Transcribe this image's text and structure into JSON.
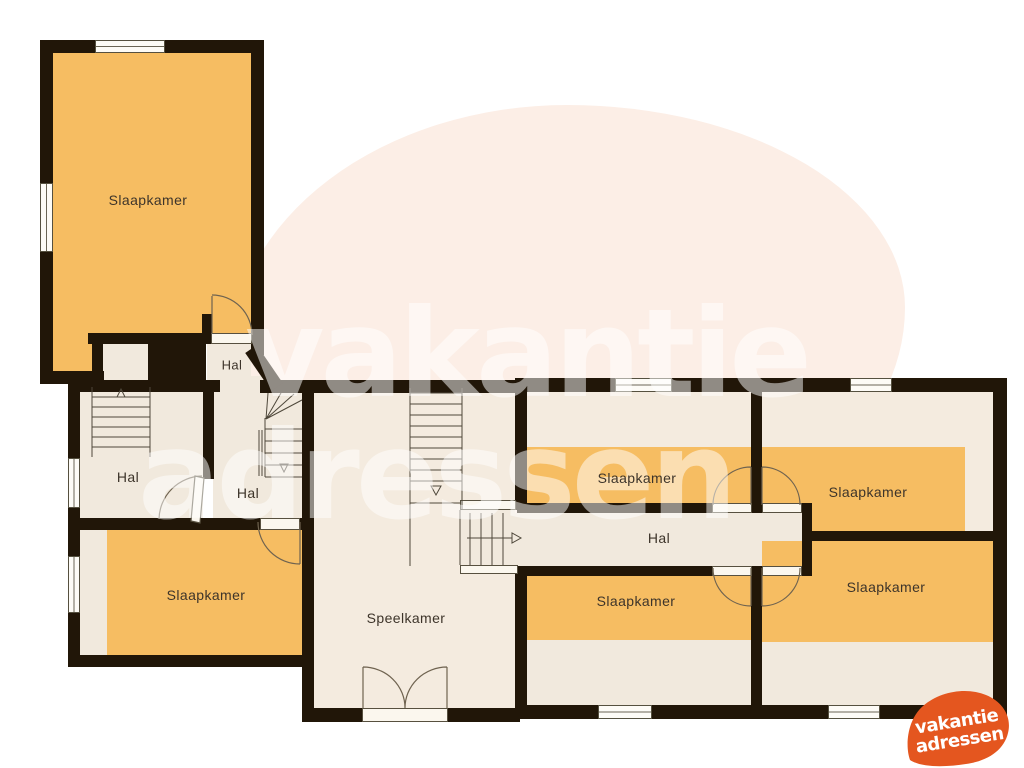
{
  "plan": {
    "rooms": {
      "bedroom_top_left": "Slaapkamer",
      "hall_top": "Hal",
      "hall_left": "Hal",
      "hall_center": "Hal",
      "bedroom_bottom_left": "Slaapkamer",
      "playroom": "Speelkamer",
      "bedroom_top_middle": "Slaapkamer",
      "bedroom_top_right": "Slaapkamer",
      "hall_corridor": "Hal",
      "bedroom_bottom_middle": "Slaapkamer",
      "bedroom_bottom_right": "Slaapkamer"
    }
  },
  "watermark": {
    "line1": "vakantie",
    "line2": "adressen"
  },
  "logo": {
    "line1": "vakantie",
    "line2": "adressen"
  },
  "colors": {
    "room_orange": "#f6bd62",
    "room_beige": "#f1e9dd",
    "playroom_beige": "#f4ebdf",
    "wall_dark": "#211608",
    "background_blob": "#fceee6",
    "logo_orange": "#e4561f",
    "label_text": "#3d342a"
  }
}
